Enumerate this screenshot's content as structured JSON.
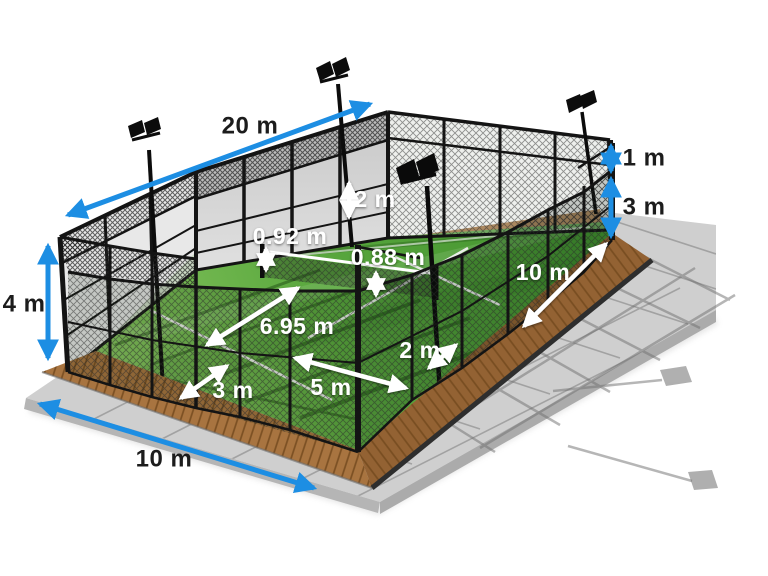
{
  "scene": {
    "title": "Padel court dimensions diagram",
    "background_color": "#ffffff",
    "colors": {
      "dimension_blue": "#1d8ee3",
      "dimension_white": "#ffffff",
      "label_dark": "#1c1c1c",
      "grass_light": "#8cc863",
      "grass_dark": "#3f8f2d",
      "wall_glass": "#d6d6d6",
      "frame_black": "#141414",
      "deck_wood": "#a06b36",
      "paving_gray": "#cfcfcf"
    },
    "elements": [
      "back wall",
      "mesh fence",
      "glass panels",
      "net",
      "floodlights",
      "wooden deck",
      "paved surround",
      "artificial grass"
    ]
  },
  "dimensions": {
    "blue": [
      {
        "id": "total-length",
        "label": "20 m"
      },
      {
        "id": "corner-post-height",
        "label": "4 m"
      },
      {
        "id": "top-mesh-height",
        "label": "1 m"
      },
      {
        "id": "side-fence-height",
        "label": "3 m"
      },
      {
        "id": "total-width",
        "label": "10 m"
      }
    ],
    "white": [
      {
        "id": "wall-panel-height",
        "label": "2 m"
      },
      {
        "id": "net-post-height",
        "label": "0.92 m"
      },
      {
        "id": "net-center-height",
        "label": "0.88 m"
      },
      {
        "id": "service-line-distance",
        "label": "6.95 m"
      },
      {
        "id": "back-distance",
        "label": "3 m"
      },
      {
        "id": "service-box-width",
        "label": "5 m"
      },
      {
        "id": "gate-width",
        "label": "2 m"
      },
      {
        "id": "half-court-length",
        "label": "10 m"
      }
    ]
  }
}
